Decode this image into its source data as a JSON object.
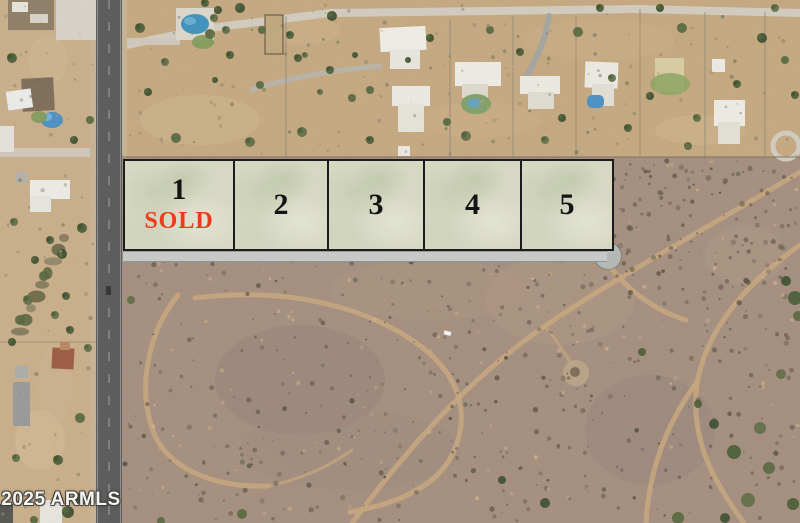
{
  "overlay": {
    "lots": [
      {
        "number": "1",
        "status": "SOLD"
      },
      {
        "number": "2",
        "status": ""
      },
      {
        "number": "3",
        "status": ""
      },
      {
        "number": "4",
        "status": ""
      },
      {
        "number": "5",
        "status": ""
      }
    ]
  },
  "watermark": {
    "text": "© 2025 ARMLS"
  },
  "colors": {
    "sold_text": "#ee3a1c",
    "lot_number_text": "#141414",
    "lot_fill": "#d6d8c3",
    "lot_border": "#1c1c1c",
    "road_bar": "#c6c9c7",
    "cul_de_sac": "#b4b9b7"
  }
}
